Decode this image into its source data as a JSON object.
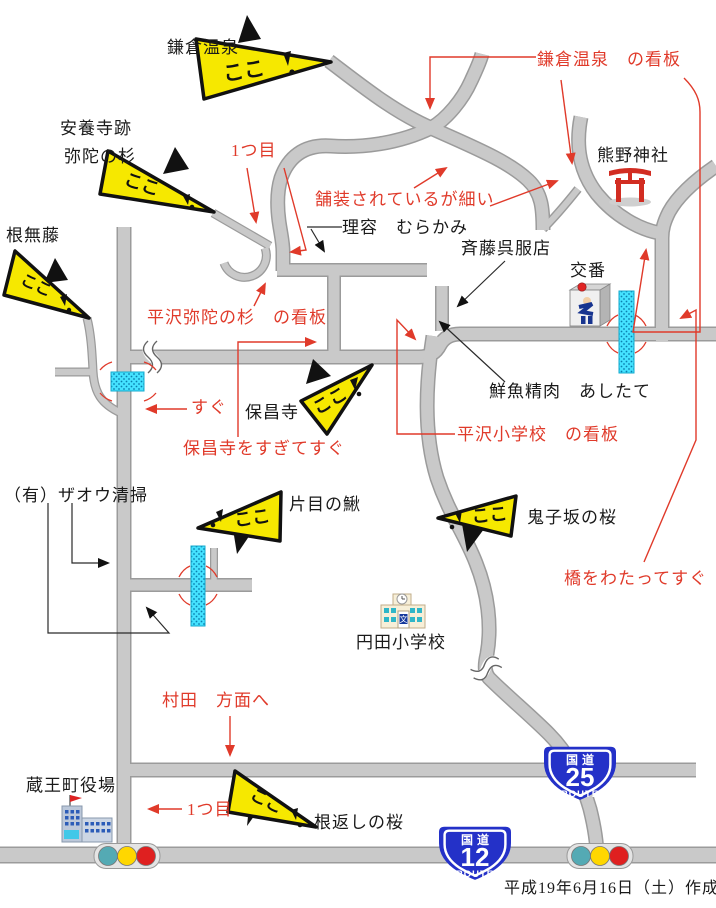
{
  "sign_text": "ここ",
  "school_mark": "文",
  "places": {
    "kamakura_onsen": "鎌倉温泉",
    "anyoji_ato": "安養寺跡",
    "mida_no_sugi": "弥陀の杉",
    "nemunashifuji": "根無藤",
    "riyo_murakami": "理容　むらかみ",
    "saito_gofukuten": "斉藤呉服店",
    "kumano_jinja": "熊野神社",
    "koban": "交番",
    "sengyo_ashitate": "鮮魚精肉　あしたて",
    "hoshoji": "保昌寺",
    "zao_seiso": "（有）ザオウ清掃",
    "katame_no_kajika": "片目の鰍",
    "onikozaka_no_sakura": "鬼子坂の桜",
    "enda_shogakko": "円田小学校",
    "zaomachi_yakuba": "蔵王町役場",
    "negaeshi_no_sakura": "根返しの桜"
  },
  "notes": {
    "kamakura_kanban": "鎌倉温泉　の看板",
    "hitotsume_top": "1つ目",
    "hosoi": "舗装されているが細い",
    "mida_kanban": "平沢弥陀の杉　の看板",
    "sugu": "すぐ",
    "hoshoji_sugu": "保昌寺をすぎてすぐ",
    "shogakko_kanban": "平沢小学校　の看板",
    "hashi_sugu": "橋をわたってすぐ",
    "murata": "村田　方面へ",
    "hitotsume_bottom": "1つ目"
  },
  "shields": [
    {
      "prefix": "国道",
      "number": "25",
      "suffix": "ROUTE"
    },
    {
      "prefix": "国道",
      "number": "12",
      "suffix": "ROUTE"
    }
  ],
  "footer": {
    "created": "平成19年6月16日（土）作成"
  },
  "colors": {
    "road_fill": "#c9c9c9",
    "road_edge": "#9b9b9b",
    "annotation_red": "#e03a2a",
    "sign_yellow": "#f6e800",
    "bridge_cyan": "#45e2ff",
    "shield_blue": "#2431c8",
    "torii_red": "#d22d22"
  }
}
